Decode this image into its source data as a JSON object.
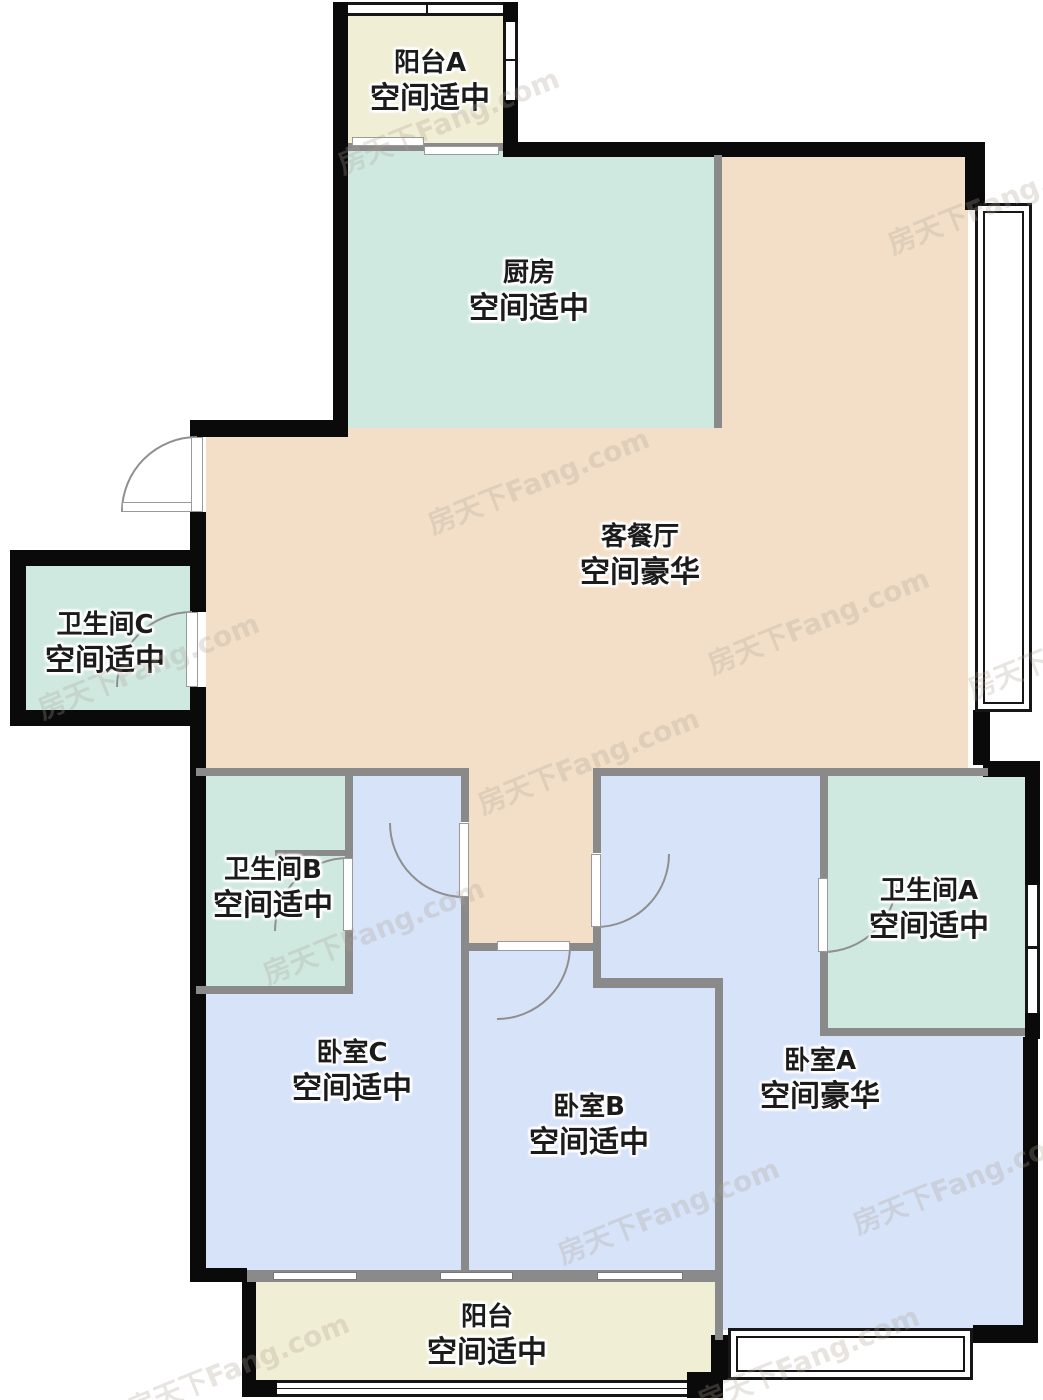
{
  "watermark": {
    "text": "房天下Fang.com"
  },
  "rooms": [
    {
      "id": "balcony-a",
      "name": "阳台A",
      "rating": "空间适中"
    },
    {
      "id": "kitchen",
      "name": "厨房",
      "rating": "空间适中"
    },
    {
      "id": "living-dining",
      "name": "客餐厅",
      "rating": "空间豪华"
    },
    {
      "id": "bathroom-c",
      "name": "卫生间C",
      "rating": "空间适中"
    },
    {
      "id": "bathroom-b",
      "name": "卫生间B",
      "rating": "空间适中"
    },
    {
      "id": "bathroom-a",
      "name": "卫生间A",
      "rating": "空间适中"
    },
    {
      "id": "bedroom-c",
      "name": "卧室C",
      "rating": "空间适中"
    },
    {
      "id": "bedroom-b",
      "name": "卧室B",
      "rating": "空间适中"
    },
    {
      "id": "bedroom-a",
      "name": "卧室A",
      "rating": "空间豪华"
    },
    {
      "id": "balcony",
      "name": "阳台",
      "rating": "空间适中"
    }
  ],
  "colors": {
    "balcony_fill": "#f1eed6",
    "kitchen_bath_fill": "#cfe9e1",
    "living_fill": "#f3dfc8",
    "bedroom_fill": "#d7e3f9",
    "wall_exterior": "#0a0a0a",
    "wall_interior": "#8a8a8a"
  }
}
